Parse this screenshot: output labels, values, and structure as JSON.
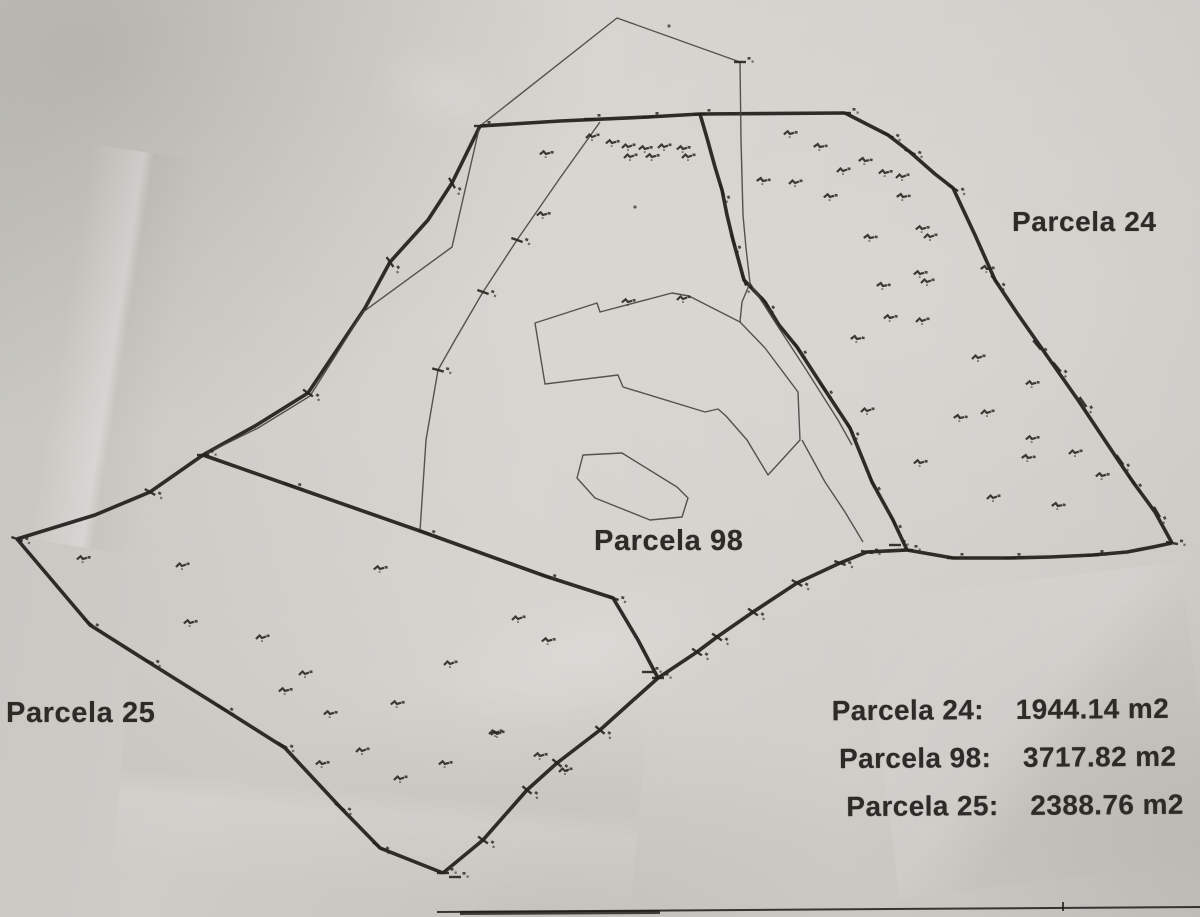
{
  "labels": {
    "parcel24": "Parcela 24",
    "parcel98": "Parcela 98",
    "parcel25": "Parcela 25"
  },
  "area_table": {
    "rows": [
      {
        "label": "Parcela 24:",
        "value": "1944.14 m2"
      },
      {
        "label": "Parcela 98:",
        "value": "3717.82 m2"
      },
      {
        "label": "Parcela 25:",
        "value": "2388.76 m2"
      }
    ]
  },
  "colors": {
    "paper": "#cfcdc8",
    "ink_thick": "#24231f",
    "ink_thin": "#45443f",
    "text": "#2c2b28"
  },
  "map_data": {
    "type": "cadastral-parcel-plan",
    "parcels": [
      {
        "name": "Parcela 24",
        "area_m2": 1944.14
      },
      {
        "name": "Parcela 98",
        "area_m2": 3717.82
      },
      {
        "name": "Parcela 25",
        "area_m2": 2388.76
      }
    ],
    "thick_lines": [
      {
        "name": "north-boundary",
        "points": [
          [
            480,
            126
          ],
          [
            560,
            121
          ],
          [
            648,
            117
          ],
          [
            700,
            114
          ],
          [
            845,
            113
          ]
        ]
      },
      {
        "name": "parcel24-east-boundary",
        "points": [
          [
            845,
            113
          ],
          [
            888,
            135
          ],
          [
            910,
            152
          ],
          [
            935,
            174
          ],
          [
            953,
            188
          ],
          [
            975,
            235
          ],
          [
            995,
            280
          ],
          [
            1017,
            313
          ],
          [
            1052,
            363
          ],
          [
            1078,
            400
          ],
          [
            1118,
            460
          ],
          [
            1133,
            482
          ],
          [
            1155,
            512
          ],
          [
            1172,
            543
          ]
        ]
      },
      {
        "name": "parcel24-south-boundary",
        "points": [
          [
            1172,
            543
          ],
          [
            1153,
            547
          ],
          [
            1127,
            552
          ],
          [
            1093,
            555
          ],
          [
            1050,
            557
          ],
          [
            1010,
            558
          ],
          [
            953,
            558
          ],
          [
            907,
            550
          ]
        ]
      },
      {
        "name": "parcel98-24-divider",
        "points": [
          [
            700,
            114
          ],
          [
            707,
            138
          ],
          [
            715,
            167
          ],
          [
            722,
            190
          ],
          [
            727,
            215
          ],
          [
            733,
            240
          ],
          [
            744,
            280
          ],
          [
            765,
            302
          ],
          [
            779,
            325
          ],
          [
            797,
            347
          ],
          [
            823,
            387
          ],
          [
            850,
            428
          ],
          [
            872,
            482
          ],
          [
            893,
            520
          ],
          [
            907,
            550
          ]
        ]
      },
      {
        "name": "parcel98-south-boundary",
        "points": [
          [
            907,
            550
          ],
          [
            867,
            552
          ],
          [
            840,
            563
          ],
          [
            797,
            583
          ],
          [
            753,
            612
          ],
          [
            717,
            637
          ],
          [
            697,
            652
          ],
          [
            658,
            678
          ]
        ]
      },
      {
        "name": "parcel25-98-divider",
        "points": [
          [
            203,
            455
          ],
          [
            300,
            489
          ],
          [
            420,
            531
          ],
          [
            545,
            576
          ],
          [
            613,
            598
          ],
          [
            638,
            640
          ],
          [
            658,
            678
          ]
        ]
      },
      {
        "name": "northwest-boundary",
        "points": [
          [
            480,
            126
          ],
          [
            452,
            183
          ],
          [
            428,
            220
          ],
          [
            390,
            262
          ],
          [
            365,
            308
          ],
          [
            308,
            393
          ],
          [
            255,
            426
          ],
          [
            203,
            455
          ]
        ]
      },
      {
        "name": "parcel25-west-boundary",
        "points": [
          [
            203,
            455
          ],
          [
            150,
            492
          ],
          [
            95,
            515
          ],
          [
            17,
            539
          ]
        ]
      },
      {
        "name": "parcel25-southwest-boundary",
        "points": [
          [
            17,
            539
          ],
          [
            90,
            625
          ],
          [
            150,
            663
          ],
          [
            225,
            710
          ],
          [
            285,
            748
          ],
          [
            340,
            807
          ],
          [
            380,
            848
          ],
          [
            443,
            873
          ]
        ]
      },
      {
        "name": "parcel25-southeast-boundary",
        "points": [
          [
            443,
            873
          ],
          [
            483,
            840
          ],
          [
            527,
            790
          ],
          [
            557,
            763
          ],
          [
            600,
            730
          ],
          [
            630,
            703
          ],
          [
            658,
            678
          ]
        ]
      }
    ],
    "thin_lines": [
      {
        "name": "summit-path",
        "closed": false,
        "points": [
          [
            480,
            126
          ],
          [
            617,
            18
          ],
          [
            740,
            62
          ],
          [
            741,
            140
          ],
          [
            743,
            215
          ],
          [
            746,
            248
          ],
          [
            750,
            283
          ]
        ]
      },
      {
        "name": "path-to-enclosure",
        "closed": false,
        "points": [
          [
            750,
            283
          ],
          [
            742,
            302
          ],
          [
            740,
            322
          ]
        ]
      },
      {
        "name": "divider-side-path",
        "closed": false,
        "points": [
          [
            750,
            283
          ],
          [
            775,
            322
          ],
          [
            805,
            368
          ],
          [
            838,
            420
          ],
          [
            852,
            445
          ]
        ]
      },
      {
        "name": "enclosure-corner-path",
        "closed": false,
        "points": [
          [
            802,
            440
          ],
          [
            825,
            482
          ],
          [
            845,
            512
          ],
          [
            863,
            542
          ]
        ]
      },
      {
        "name": "northwest-side-path",
        "closed": false,
        "points": [
          [
            479,
            129
          ],
          [
            452,
            247
          ],
          [
            363,
            312
          ],
          [
            310,
            396
          ],
          [
            258,
            428
          ],
          [
            207,
            453
          ]
        ]
      },
      {
        "name": "interior-path-98",
        "closed": false,
        "points": [
          [
            600,
            122
          ],
          [
            560,
            178
          ],
          [
            517,
            240
          ],
          [
            483,
            292
          ],
          [
            455,
            340
          ],
          [
            438,
            370
          ],
          [
            426,
            440
          ],
          [
            420,
            531
          ]
        ]
      },
      {
        "name": "central-enclosure-outline",
        "closed": true,
        "points": [
          [
            535,
            323
          ],
          [
            597,
            303
          ],
          [
            600,
            312
          ],
          [
            672,
            293
          ],
          [
            689,
            296
          ],
          [
            740,
            322
          ],
          [
            765,
            348
          ],
          [
            798,
            392
          ],
          [
            800,
            440
          ],
          [
            768,
            475
          ],
          [
            747,
            440
          ],
          [
            726,
            416
          ],
          [
            718,
            409
          ],
          [
            705,
            412
          ],
          [
            623,
            387
          ],
          [
            618,
            375
          ],
          [
            545,
            384
          ]
        ]
      },
      {
        "name": "small-enclosure-outline",
        "closed": true,
        "points": [
          [
            583,
            455
          ],
          [
            622,
            453
          ],
          [
            677,
            487
          ],
          [
            688,
            498
          ],
          [
            682,
            517
          ],
          [
            650,
            520
          ],
          [
            595,
            498
          ],
          [
            577,
            478
          ]
        ]
      }
    ],
    "ticks": [
      [
        888,
        135,
        25
      ],
      [
        910,
        152,
        25
      ],
      [
        953,
        188,
        30
      ],
      [
        995,
        280,
        50
      ],
      [
        1037,
        345,
        50
      ],
      [
        1057,
        367,
        50
      ],
      [
        1083,
        402,
        55
      ],
      [
        1120,
        460,
        55
      ],
      [
        1132,
        480,
        55
      ],
      [
        1157,
        512,
        60
      ],
      [
        1172,
        543,
        10
      ],
      [
        1093,
        555,
        0
      ],
      [
        1010,
        558,
        0
      ],
      [
        953,
        558,
        0
      ],
      [
        907,
        550,
        0
      ],
      [
        895,
        545,
        0
      ],
      [
        867,
        552,
        10
      ],
      [
        840,
        563,
        20
      ],
      [
        797,
        583,
        30
      ],
      [
        753,
        612,
        35
      ],
      [
        717,
        637,
        35
      ],
      [
        697,
        652,
        35
      ],
      [
        658,
        678,
        0
      ],
      [
        648,
        672,
        0
      ],
      [
        600,
        730,
        40
      ],
      [
        557,
        763,
        40
      ],
      [
        527,
        790,
        40
      ],
      [
        483,
        840,
        35
      ],
      [
        443,
        873,
        0
      ],
      [
        455,
        877,
        0
      ],
      [
        340,
        807,
        35
      ],
      [
        378,
        846,
        35
      ],
      [
        282,
        745,
        30
      ],
      [
        222,
        708,
        30
      ],
      [
        148,
        661,
        25
      ],
      [
        88,
        622,
        40
      ],
      [
        17,
        539,
        20
      ],
      [
        150,
        492,
        30
      ],
      [
        290,
        485,
        20
      ],
      [
        424,
        532,
        20
      ],
      [
        545,
        576,
        20
      ],
      [
        613,
        598,
        20
      ],
      [
        722,
        190,
        70
      ],
      [
        733,
        240,
        70
      ],
      [
        744,
        280,
        70
      ],
      [
        765,
        302,
        55
      ],
      [
        797,
        347,
        55
      ],
      [
        823,
        387,
        55
      ],
      [
        850,
        428,
        60
      ],
      [
        872,
        482,
        65
      ],
      [
        893,
        520,
        65
      ],
      [
        452,
        183,
        60
      ],
      [
        390,
        262,
        55
      ],
      [
        308,
        393,
        35
      ],
      [
        203,
        455,
        0
      ],
      [
        590,
        119,
        0
      ],
      [
        648,
        117,
        0
      ],
      [
        700,
        114,
        0
      ],
      [
        480,
        126,
        0
      ],
      [
        845,
        113,
        0
      ],
      [
        517,
        240,
        20
      ],
      [
        483,
        292,
        20
      ],
      [
        438,
        370,
        15
      ],
      [
        740,
        62,
        0
      ]
    ],
    "point_markers": [
      [
        763,
        180,
        10
      ],
      [
        790,
        133,
        5
      ],
      [
        795,
        182,
        0
      ],
      [
        820,
        146,
        10
      ],
      [
        830,
        196,
        5
      ],
      [
        843,
        170,
        0
      ],
      [
        865,
        160,
        10
      ],
      [
        885,
        172,
        5
      ],
      [
        902,
        176,
        0
      ],
      [
        903,
        196,
        10
      ],
      [
        922,
        228,
        5
      ],
      [
        930,
        236,
        0
      ],
      [
        870,
        237,
        10
      ],
      [
        920,
        273,
        5
      ],
      [
        927,
        281,
        0
      ],
      [
        883,
        285,
        10
      ],
      [
        890,
        317,
        5
      ],
      [
        922,
        320,
        0
      ],
      [
        857,
        338,
        10
      ],
      [
        867,
        410,
        0
      ],
      [
        920,
        462,
        5
      ],
      [
        987,
        268,
        10
      ],
      [
        978,
        357,
        0
      ],
      [
        1032,
        383,
        5
      ],
      [
        960,
        417,
        10
      ],
      [
        987,
        412,
        0
      ],
      [
        1032,
        438,
        5
      ],
      [
        1028,
        457,
        10
      ],
      [
        1075,
        452,
        0
      ],
      [
        1102,
        475,
        5
      ],
      [
        993,
        497,
        0
      ],
      [
        1058,
        505,
        10
      ],
      [
        546,
        153,
        5
      ],
      [
        592,
        136,
        0
      ],
      [
        612,
        142,
        5
      ],
      [
        628,
        146,
        0
      ],
      [
        645,
        148,
        5
      ],
      [
        664,
        146,
        0
      ],
      [
        683,
        148,
        5
      ],
      [
        688,
        156,
        0
      ],
      [
        652,
        156,
        5
      ],
      [
        630,
        156,
        0
      ],
      [
        543,
        214,
        5
      ],
      [
        628,
        301,
        5
      ],
      [
        683,
        298,
        0
      ],
      [
        83,
        558,
        5
      ],
      [
        182,
        565,
        0
      ],
      [
        190,
        622,
        5
      ],
      [
        262,
        637,
        0
      ],
      [
        285,
        690,
        5
      ],
      [
        305,
        673,
        0
      ],
      [
        330,
        713,
        5
      ],
      [
        362,
        750,
        0
      ],
      [
        322,
        763,
        5
      ],
      [
        400,
        778,
        0
      ],
      [
        445,
        763,
        5
      ],
      [
        497,
        733,
        0
      ],
      [
        380,
        568,
        5
      ],
      [
        450,
        663,
        0
      ],
      [
        397,
        703,
        5
      ],
      [
        495,
        732,
        0
      ],
      [
        540,
        755,
        5
      ],
      [
        565,
        770,
        0
      ],
      [
        518,
        618,
        0
      ],
      [
        548,
        640,
        5
      ]
    ],
    "dots": [
      [
        669,
        26
      ],
      [
        635,
        207
      ]
    ],
    "bottom_border": {
      "main": [
        [
          437,
          912
        ],
        [
          1200,
          907
        ]
      ],
      "thick_segment": [
        [
          460,
          913
        ],
        [
          660,
          912
        ]
      ],
      "tick": [
        1063,
        906
      ]
    }
  }
}
